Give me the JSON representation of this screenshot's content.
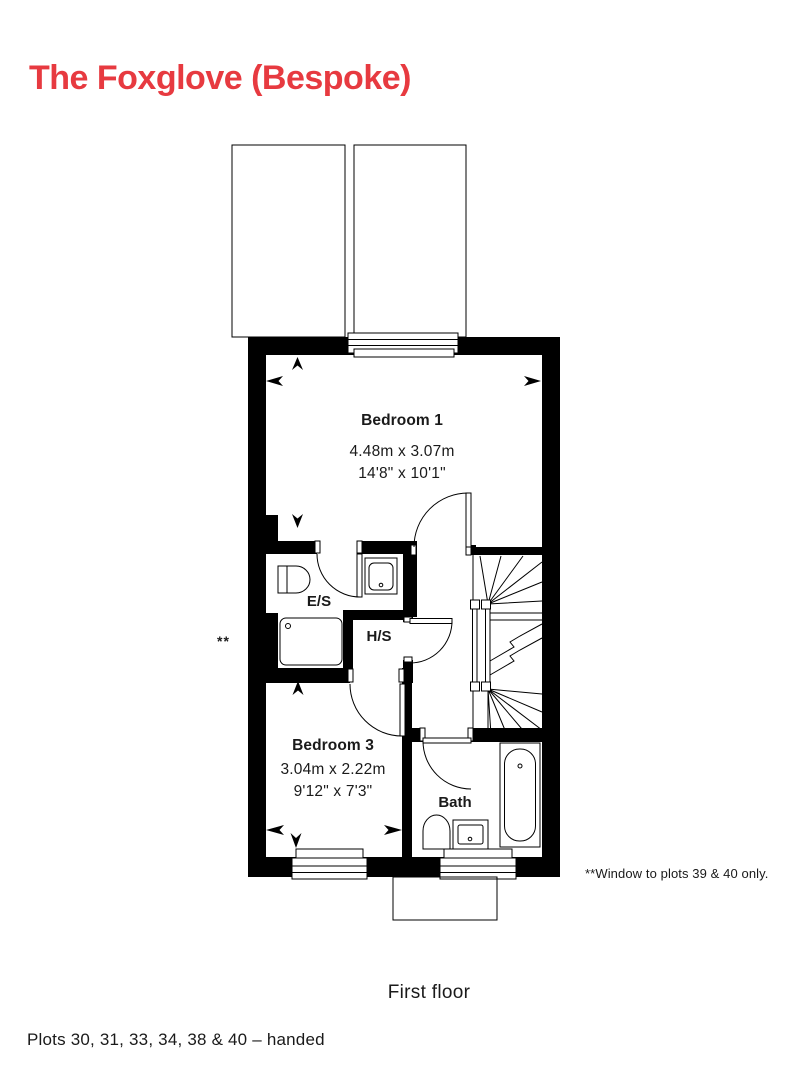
{
  "title": "The Foxglove (Bespoke)",
  "floor_caption": "First floor",
  "plots_line": "Plots 30, 31, 33, 34, 38 & 40 – handed",
  "footnote": {
    "marker": "**",
    "text": "**Window to plots 39 & 40 only."
  },
  "rooms": {
    "bedroom1": {
      "name": "Bedroom 1",
      "metric": "4.48m x 3.07m",
      "imperial": "14'8\" x 10'1\""
    },
    "bedroom3": {
      "name": "Bedroom 3",
      "metric": "3.04m x 2.22m",
      "imperial": "9'12\" x 7'3\""
    },
    "ensuite": {
      "name": "E/S"
    },
    "hotpress": {
      "name": "H/S"
    },
    "bath": {
      "name": "Bath"
    }
  },
  "colors": {
    "accent_red": "#e73a40",
    "plan_ink": "#000000",
    "text_ink": "#1a1a1a"
  }
}
